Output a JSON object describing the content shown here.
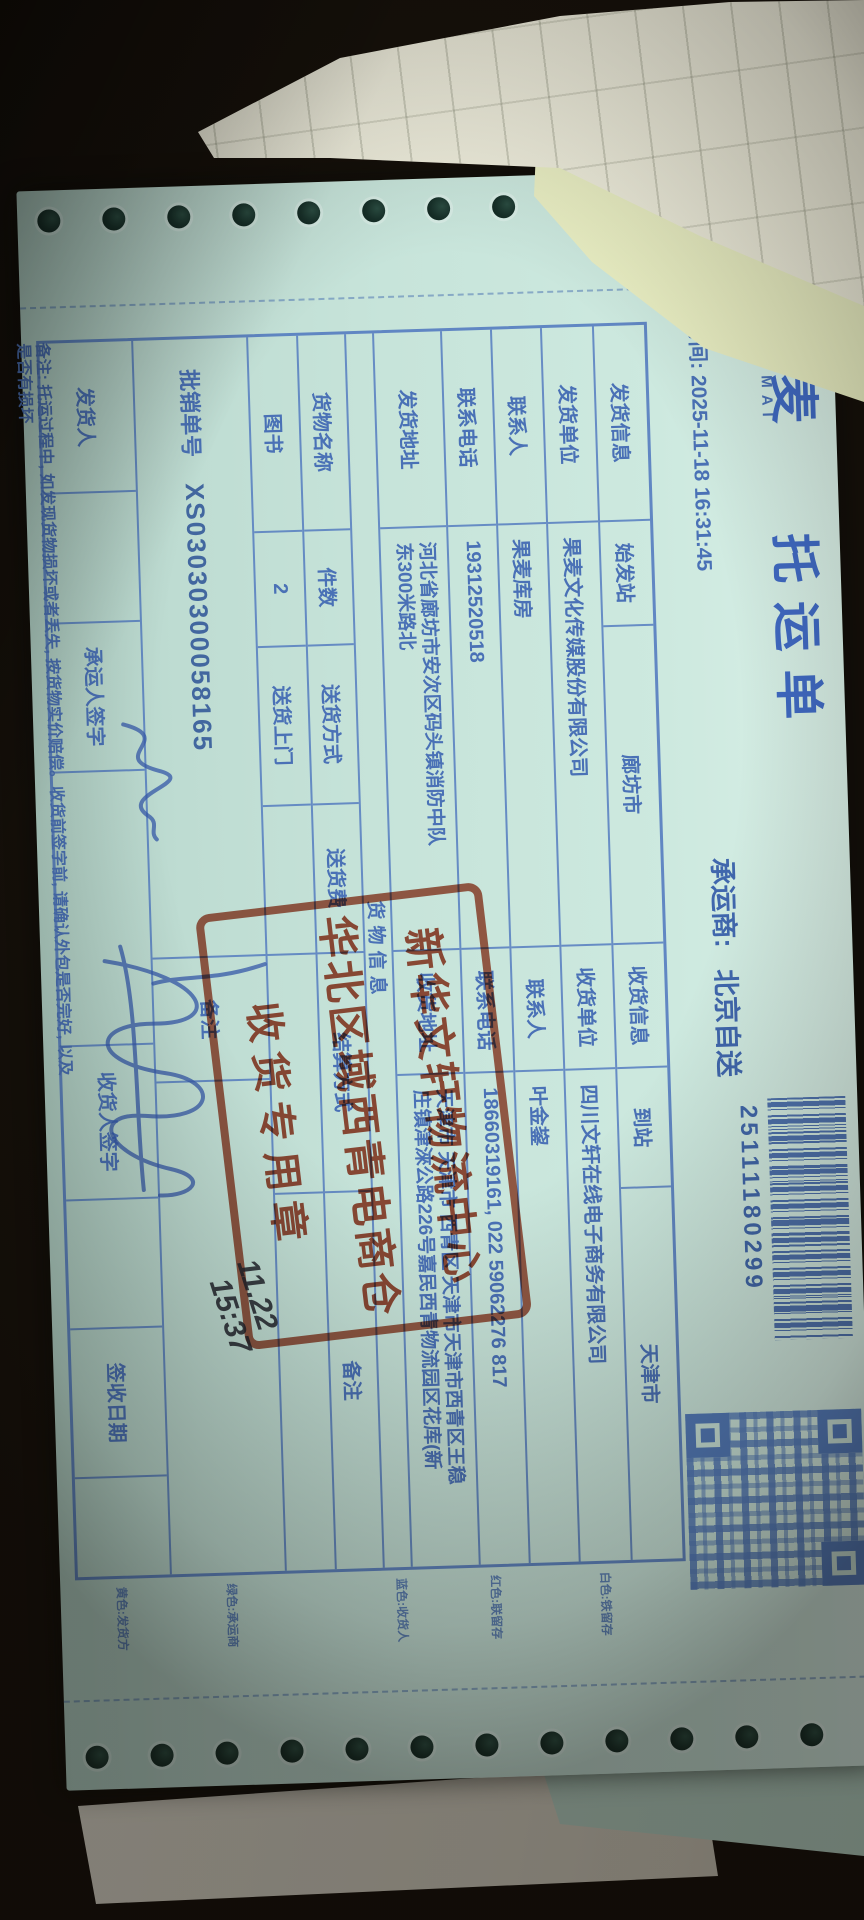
{
  "form": {
    "brand": "果麦",
    "brand_sub": "GUOMAI",
    "title": "托运单",
    "time": "时间: 2025-11-18 16:31:45",
    "carrier_label": "承运商:",
    "carrier_value": "北京自送",
    "waybill_no": "25111180299",
    "row1": {
      "ship_info": "发货信息",
      "origin_label": "始发站",
      "origin": "廊坊市",
      "recv_info": "收货信息",
      "dest_label": "到站",
      "dest": "天津市"
    },
    "shipper": {
      "unit_label": "发货单位",
      "unit": "果麦文化传媒股份有限公司",
      "contact_label": "联系人",
      "contact": "果麦库房",
      "phone_label": "联系电话",
      "phone": "19312520518",
      "addr_label": "发货地址",
      "addr1": "河北省廊坊市安次区码头镇消防中队",
      "addr2": "东300米路北"
    },
    "receiver": {
      "unit_label": "收货单位",
      "unit": "四川文轩在线电子商务有限公司",
      "contact_label": "联系人",
      "contact": "叶金鋆",
      "phone_label": "联系电话",
      "phone": "18660319161, 022 59062276 817",
      "addr_label": "收货地址",
      "addr1": "天津市 天津市 西青区 天津市天津市西青区王稳",
      "addr2": "庄镇津淶公路226号嘉民西青物流园区花库(新"
    },
    "goods_section": "货物信息",
    "goods_headers": [
      "货物名称",
      "件数",
      "送货方式",
      "送货费",
      "结算方式",
      "备注"
    ],
    "goods_values": [
      "图书",
      "2",
      "送货上门",
      "",
      "",
      ""
    ],
    "order_label": "批销单号",
    "order_no": "XS03030300058165",
    "order_note_label": "备注",
    "sign_row": {
      "shipper_label": "发货人",
      "carrier_sign_label": "承运人签字",
      "receiver_sign_label": "收货人签字",
      "date_label": "签收日期"
    },
    "bottom_note_1": "备注: 托运过程中, 如发现货物损坏或者丢失, 按货物实价赔偿。收货前签字前, 请确认外包是否完好, 以及",
    "bottom_note_2": "是否有损坏",
    "copy_legends": [
      "白色:铁留存",
      "红色:联留存",
      "蓝色:收货人",
      "绿色:承运商",
      "黄色:发货方"
    ],
    "stamp": {
      "line1": "新华文轩物流中心",
      "line2": "华北区域西青电商仓",
      "line3": "收货专用章"
    },
    "handwriting": {
      "date": "11.22",
      "time": "15:37"
    }
  },
  "colors": {
    "print_blue": "#4a71b6",
    "title_blue": "#3f69c2",
    "stamp_red": "#a33821",
    "paper_cyan": "#c7e4da",
    "paper_yellow": "#e8edc2",
    "paper_cream": "#ebe9d8",
    "pen_blue": "#3558a8",
    "pen_black": "#20222a",
    "table_background": "#2b1f14"
  }
}
